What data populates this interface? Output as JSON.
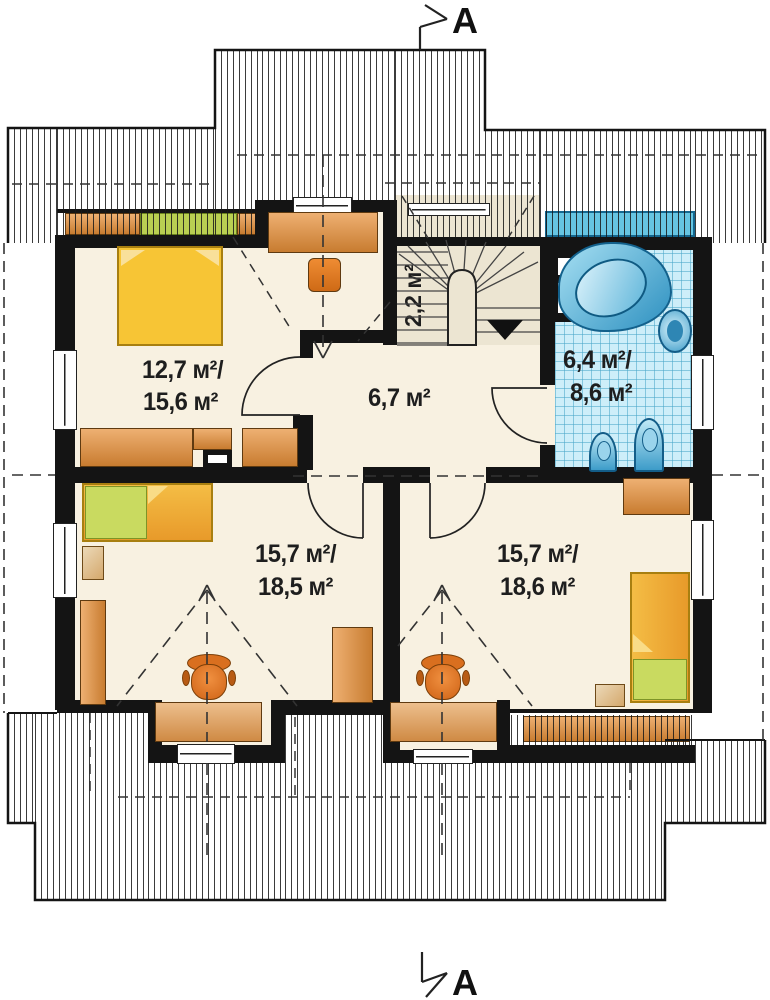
{
  "plan_title": "attic floor plan",
  "markers": {
    "top": "A",
    "bottom": "A"
  },
  "rooms": {
    "bedroom": {
      "line1": "12,7 м²/",
      "line2": "15,6 м²"
    },
    "hall": {
      "line1": "6,7 м²"
    },
    "stairwell": {
      "line1": "2,2 м²"
    },
    "bathroom": {
      "line1": "6,4 м²/",
      "line2": "8,6 м²"
    },
    "room_left": {
      "line1": "15,7 м²/",
      "line2": "18,5 м²"
    },
    "room_right": {
      "line1": "15,7 м²/",
      "line2": "18,6 м²"
    }
  },
  "colors": {
    "wall": "#141414",
    "floor": "#f8f1e1",
    "stairs_floor": "#ece5d2",
    "furniture_orange": "#d9893b",
    "bed_yellow": "#f6c230",
    "pillow_green": "#b9cf52",
    "bath_tile": "#cdeef9",
    "fixture_blue": "#3d9cc9",
    "skylight_blue": "#66c5e2"
  }
}
